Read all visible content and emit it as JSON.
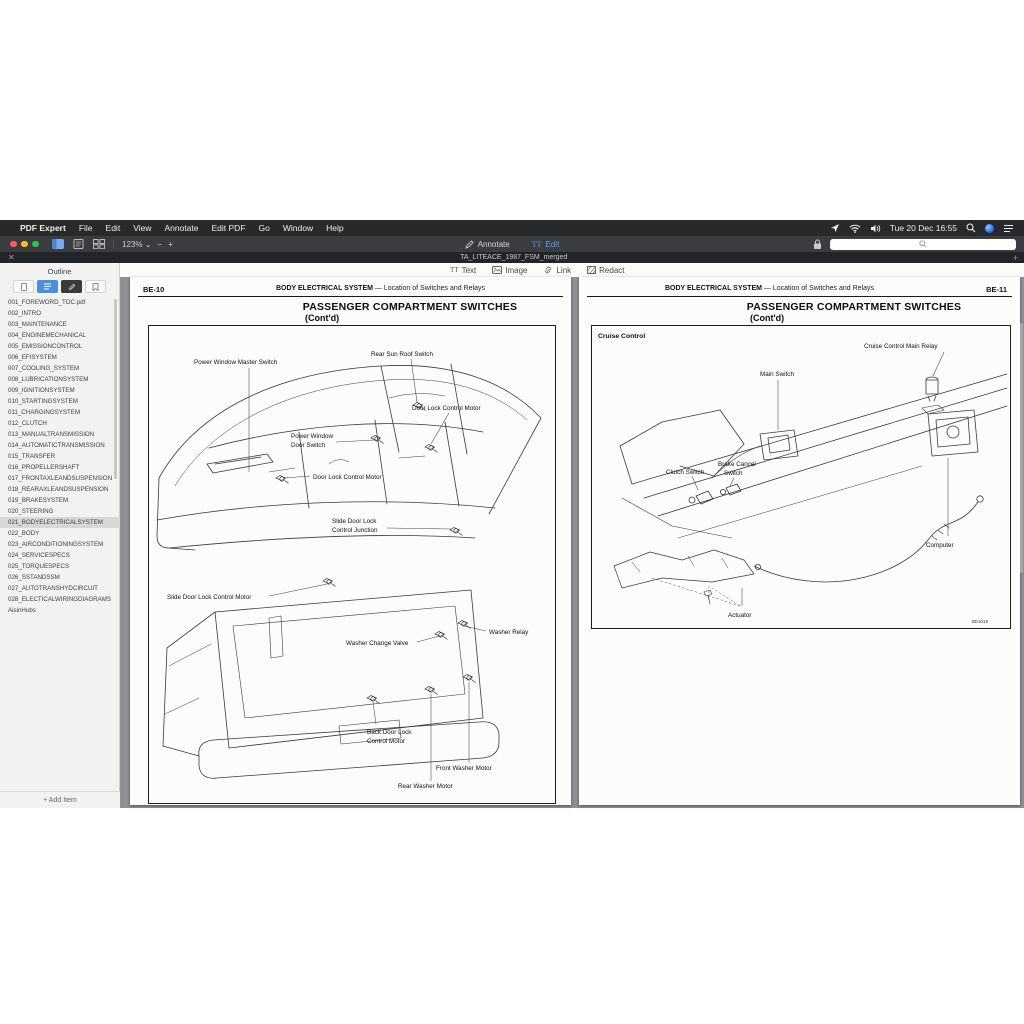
{
  "menu_bar": {
    "apple": "",
    "app_name": "PDF Expert",
    "items": [
      "File",
      "Edit",
      "View",
      "Annotate",
      "Edit PDF",
      "Go",
      "Window",
      "Help"
    ],
    "clock": "Tue 20 Dec 16:55"
  },
  "toolbar": {
    "zoom_level": "123%",
    "zoom_caret": "⌄",
    "zoom_out": "−",
    "zoom_in": "+",
    "annotate_tab": "Annotate",
    "edit_tab": "Edit",
    "edit_tab_icon": "TT"
  },
  "tab_bar": {
    "close": "✕",
    "title": "TA_LITEACE_1987_FSM_merged",
    "add": "+"
  },
  "edit_toolbar": {
    "text_icon": "TT",
    "items": [
      "Text",
      "Image",
      "Link",
      "Redact"
    ]
  },
  "sidebar": {
    "title": "Outline",
    "add_item": "+ Add Item",
    "items": [
      "001_FOREWORD_TOC.pdf",
      "002_INTRO",
      "003_MAINTENANCE",
      "004_ENGINEMECHANICAL",
      "005_EMISSIONCONTROL",
      "006_EFISYSTEM",
      "007_COOLING_SYSTEM",
      "008_LUBRICATIONSYSTEM",
      "009_IGNITIONSYSTEM",
      "010_STARTINGSYSTEM",
      "011_CHARGINGSYSTEM",
      "012_CLUTCH",
      "013_MANUALTRANSMISSION",
      "014_AUTOMATICTRANSMISSION",
      "015_TRANSFER",
      "016_PROPELLERSHAFT",
      "017_FRONTAXLEANDSUSPENSION",
      "018_REARAXLEANDSUSPENSION",
      "019_BRAKESYSTEM",
      "020_STEERING",
      "021_BODYELECTRICALSYSTEM",
      "022_BODY",
      "023_AIRCONDITIONINGSYSTEM",
      "024_SERVICESPECS",
      "025_TORQUESPECS",
      "026_SSTANDSSM",
      "027_AUTOTRANSHYDCIRCUIT",
      "028_ELECTICALWIRINGDIAGRAMS",
      "AisinHubs"
    ]
  },
  "left_page": {
    "page_no": "BE-10",
    "section": "BODY ELECTRICAL SYSTEM",
    "section_sub": "—  Location of Switches and Relays",
    "title": "PASSENGER COMPARTMENT SWITCHES",
    "cont": "(Cont'd)",
    "labels": [
      "Power Window Master Switch",
      "Rear Sun Roof Switch",
      "Door Lock Control Motor",
      "Power Window",
      "Door Switch",
      "Door Lock Control Motor",
      "Slide Door Lock",
      "Control Junction",
      "Slide Door Lock Control Motor",
      "Washer Change Valve",
      "Washer Relay",
      "Back Door Lock",
      "Control Motor",
      "Front Washer Motor",
      "Rear Washer Motor"
    ]
  },
  "right_page": {
    "page_no": "BE-11",
    "section": "BODY ELECTRICAL SYSTEM",
    "section_sub": "—  Location of Switches and Relays",
    "title": "PASSENGER COMPARTMENT SWITCHES",
    "cont": "(Cont'd)",
    "box_title": "Cruise Control",
    "figure_code": "BE1019",
    "labels": [
      "Cruise Control Main Relay",
      "Main Switch",
      "Clutch Switch",
      "Brake Cancel",
      "Switch",
      "Computer",
      "Actuator"
    ]
  }
}
